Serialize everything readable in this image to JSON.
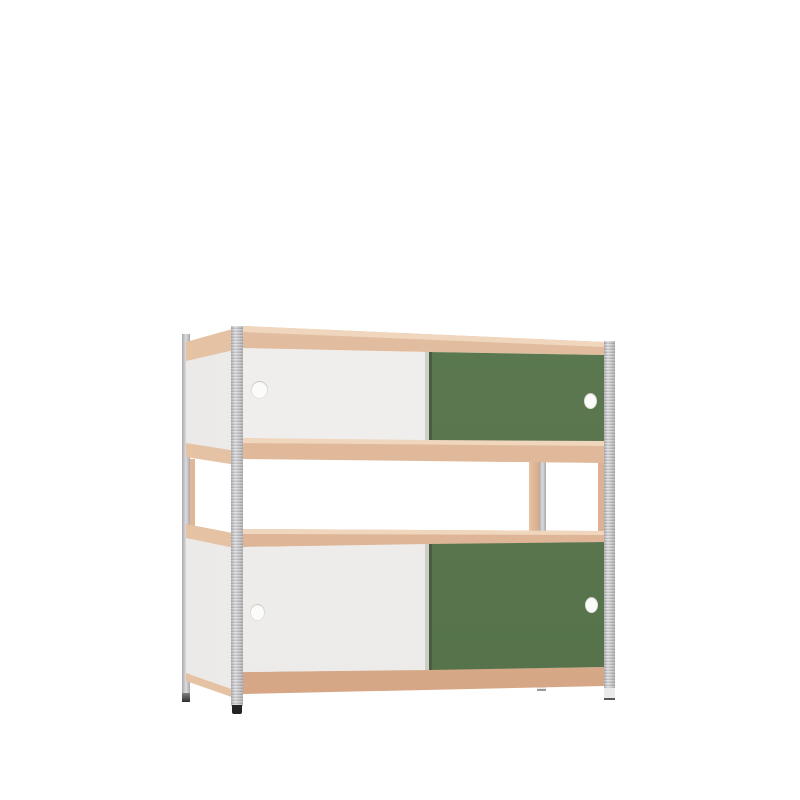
{
  "scene": {
    "kind": "product-render",
    "object": "double stacked shelving unit with sliding-door cabinets",
    "view": "three-quarter front-left perspective on plain background",
    "sections": [
      "top cabinet with sliding doors",
      "open middle shelf",
      "bottom cabinet with sliding doors"
    ],
    "cabinets": [
      {
        "position": "top",
        "left_door": "white sliding door with finger hole",
        "right_door": "green sliding door with finger hole"
      },
      {
        "position": "bottom",
        "left_door": "white sliding door with finger hole",
        "right_door": "green sliding door with finger hole"
      }
    ],
    "frame": "four galvanized slotted steel posts with feet",
    "shelves": "plywood shelves with exposed wooden edge bands"
  },
  "colors": {
    "background": "#ffffff",
    "wood": "#e2bc9e",
    "wood_light": "#efd6bd",
    "wood_side": "#e6c2a4",
    "wood_dark": "#d8ab8a",
    "wood_deep": "#d2a07e",
    "panel_white": "#f1efed",
    "door_white": "#f4f2f1",
    "door_white_dim": "#eceae8",
    "door_green": "#607d55",
    "door_green_dark": "#54714a",
    "door_green_edge": "#475e3e",
    "metal_hi": "#dcdcde",
    "metal": "#c6c6c8",
    "metal_dark": "#a8a8ab",
    "foot_dark": "#232325",
    "foot_mid": "#808083",
    "foot_light": "#eaeaeb",
    "hole_fill": "#fbfbfa"
  }
}
